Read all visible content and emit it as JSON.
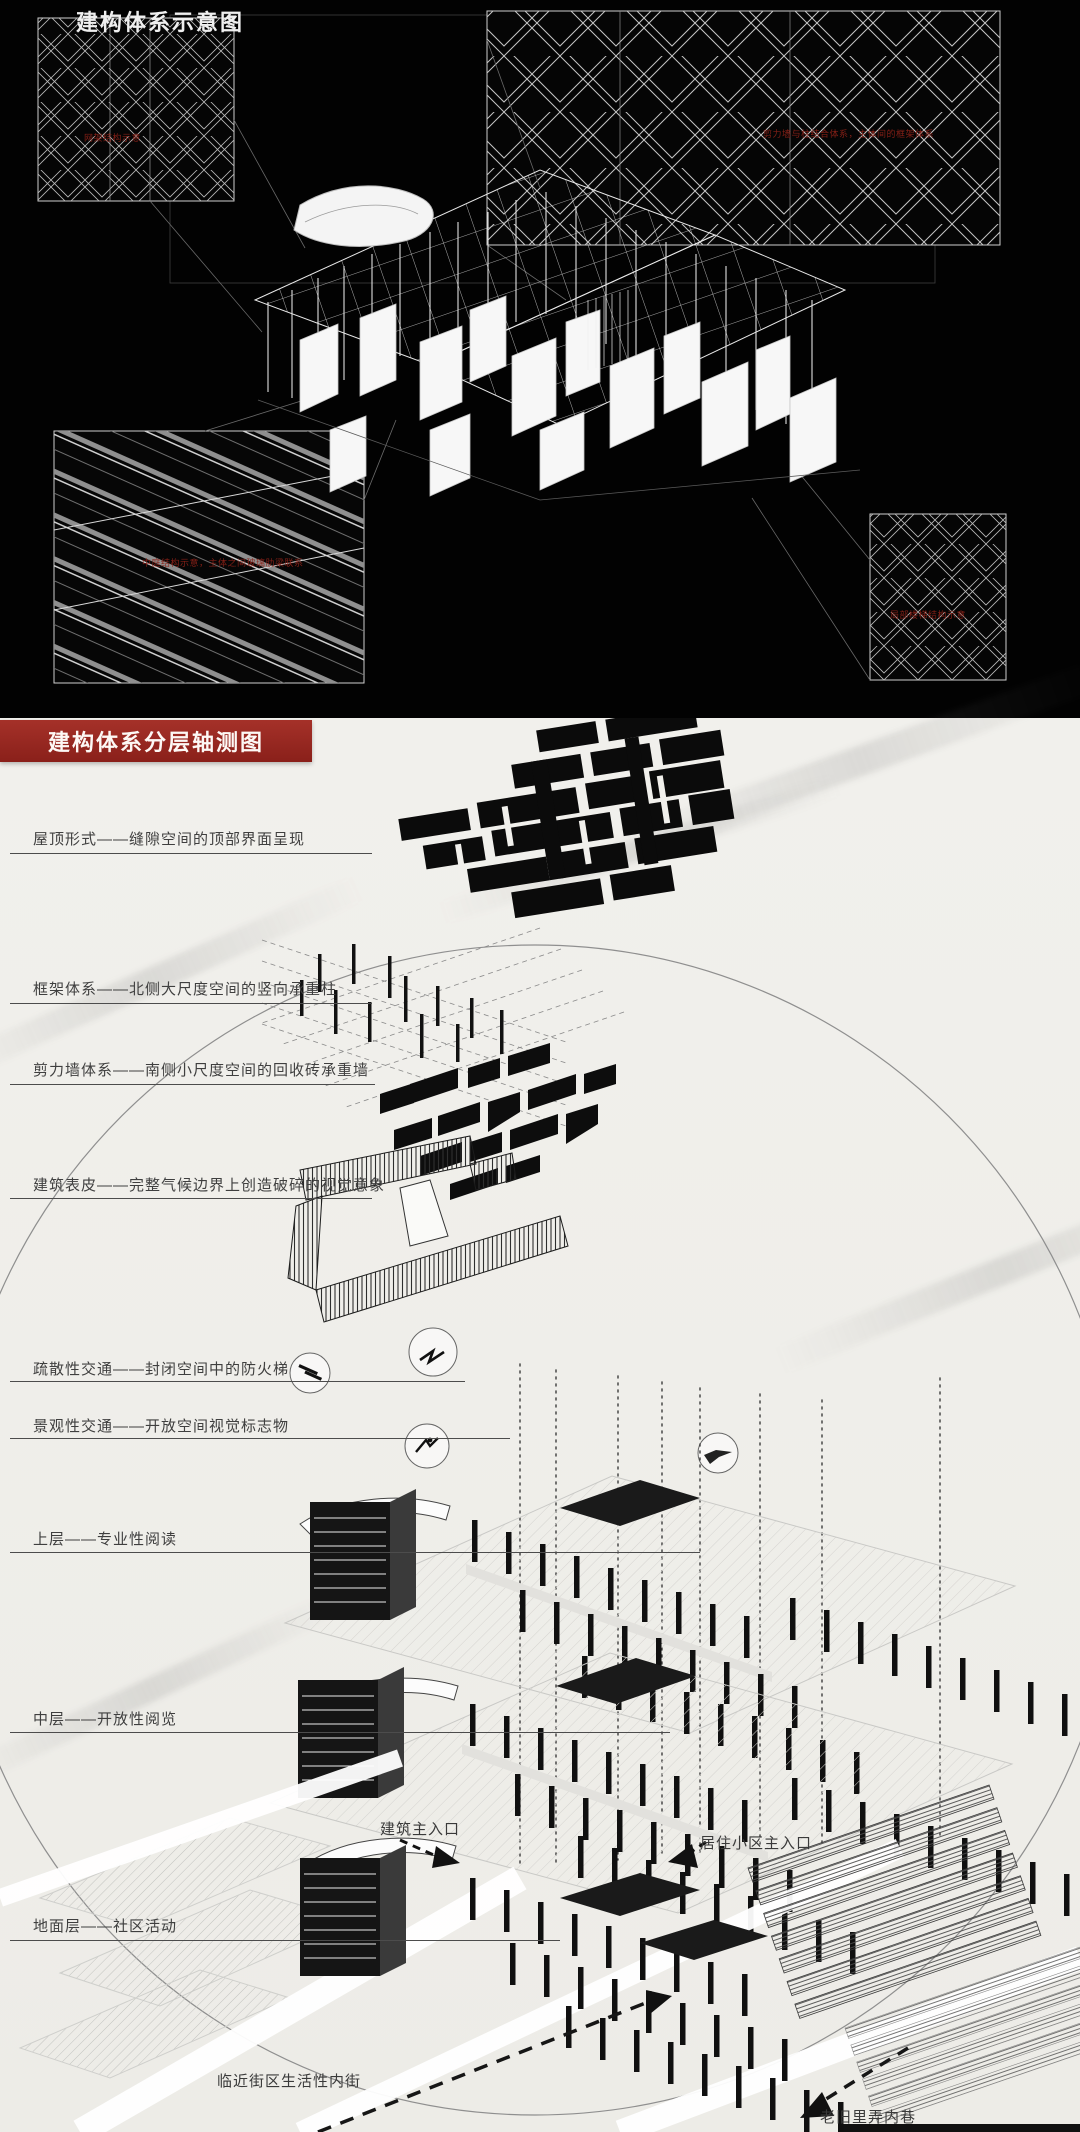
{
  "top_section": {
    "title": "建构体系示意图",
    "notes": {
      "top_left": "网架结构示意",
      "top_right": "剪力墙与柱结合体系，主体间的框架体系",
      "bottom_left": "中庭结构示意，主体之间玻璃肋梁联系",
      "bottom_right": "局部楼梯结构示意"
    }
  },
  "bottom_section": {
    "title": "建构体系分层轴测图",
    "layer_labels": [
      "屋顶形式——缝隙空间的顶部界面呈现",
      "框架体系——北侧大尺度空间的竖向承重柱",
      "剪力墙体系——南侧小尺度空间的回收砖承重墙",
      "建筑表皮——完整气候边界上创造破碎的视觉意象",
      "疏散性交通——封闭空间中的防火梯",
      "景观性交通——开放空间视觉标志物",
      "上层——专业性阅读",
      "中层——开放性阅览",
      "地面层——社区活动"
    ],
    "annotations": {
      "building_entrance": "建筑主入口",
      "residential_entrance": "居住小区主入口",
      "street": "临近街区生活性内街",
      "alley": "老旧里弄内巷"
    }
  },
  "colors": {
    "banner_red": "#9c2922",
    "note_red": "#8d2218",
    "paper": "#efeeea",
    "ink": "#3f3f3f",
    "black_bg": "#020202"
  }
}
